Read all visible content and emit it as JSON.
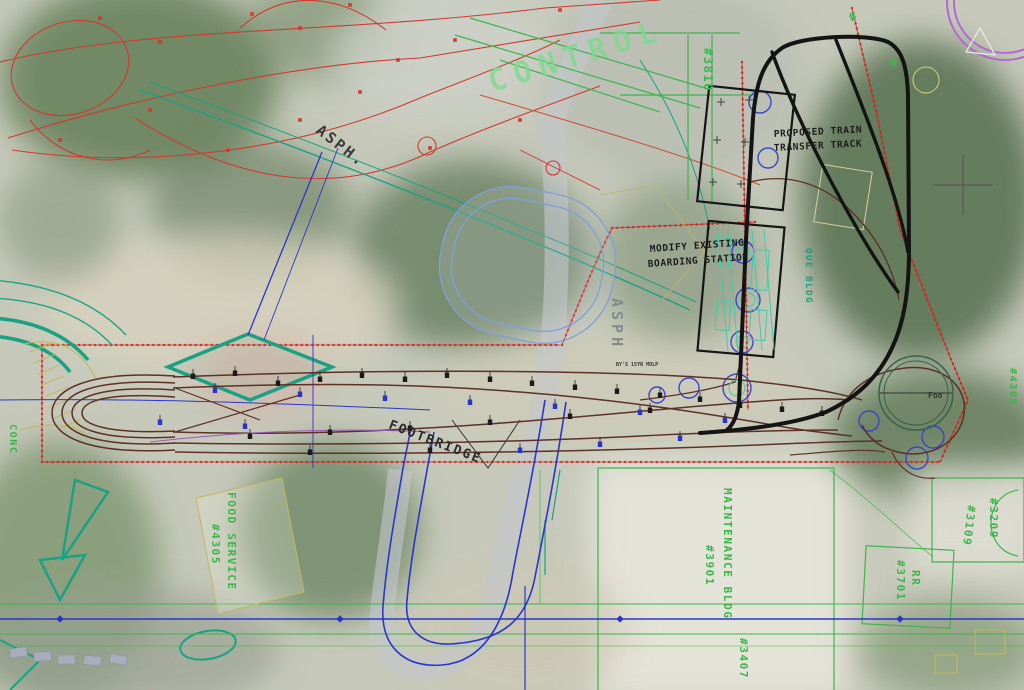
{
  "drawing": {
    "annotations": {
      "proposed_track_line1": "PROPOSED TRAIN",
      "proposed_track_line2": "TRANSFER TRACK",
      "modify_station_line1": "MODIFY EXISTING",
      "modify_station_line2": "BOARDING STATION",
      "footbridge": "FOOTBRIDGE",
      "asph_diagonal": "ASPH.",
      "asph_vertical": "ASPH",
      "survey_note": "BY'S 15YR MOLP",
      "turntable_note": "Foo"
    },
    "site_labels": {
      "control": "CONTROL",
      "bldg_3810": "#3810",
      "que_bldg": "QUE BLDG",
      "food_service_line1": "FOOD SERVICE",
      "food_service_line2": "#4305",
      "maintenance_line1": "MAINTENANCE BLDG",
      "maintenance_line2": "#3901",
      "bldg_3209": "#3209",
      "bldg_3109": "#3109",
      "rr_line1": "RR",
      "rr_line2": "#3701",
      "bldg_3407": "#3407",
      "conc": "CONC",
      "bldg_4309": "#4309",
      "hash_mark_1": "#",
      "hash_mark_2": "#"
    },
    "colors": {
      "proposed_track": "#141414",
      "boundary_red": "#cc2b24",
      "cad_red": "#d03a30",
      "yard_track_brown": "#5d3126",
      "building_green": "#3cb54a",
      "control_green": "#7fd98f",
      "teal": "#1aa184",
      "cad_blue": "#2b37c8",
      "light_blue": "#8fa8d8",
      "olive": "#c0b85a",
      "purple": "#b06ad0",
      "photo_base": "#c6c9ba"
    }
  }
}
